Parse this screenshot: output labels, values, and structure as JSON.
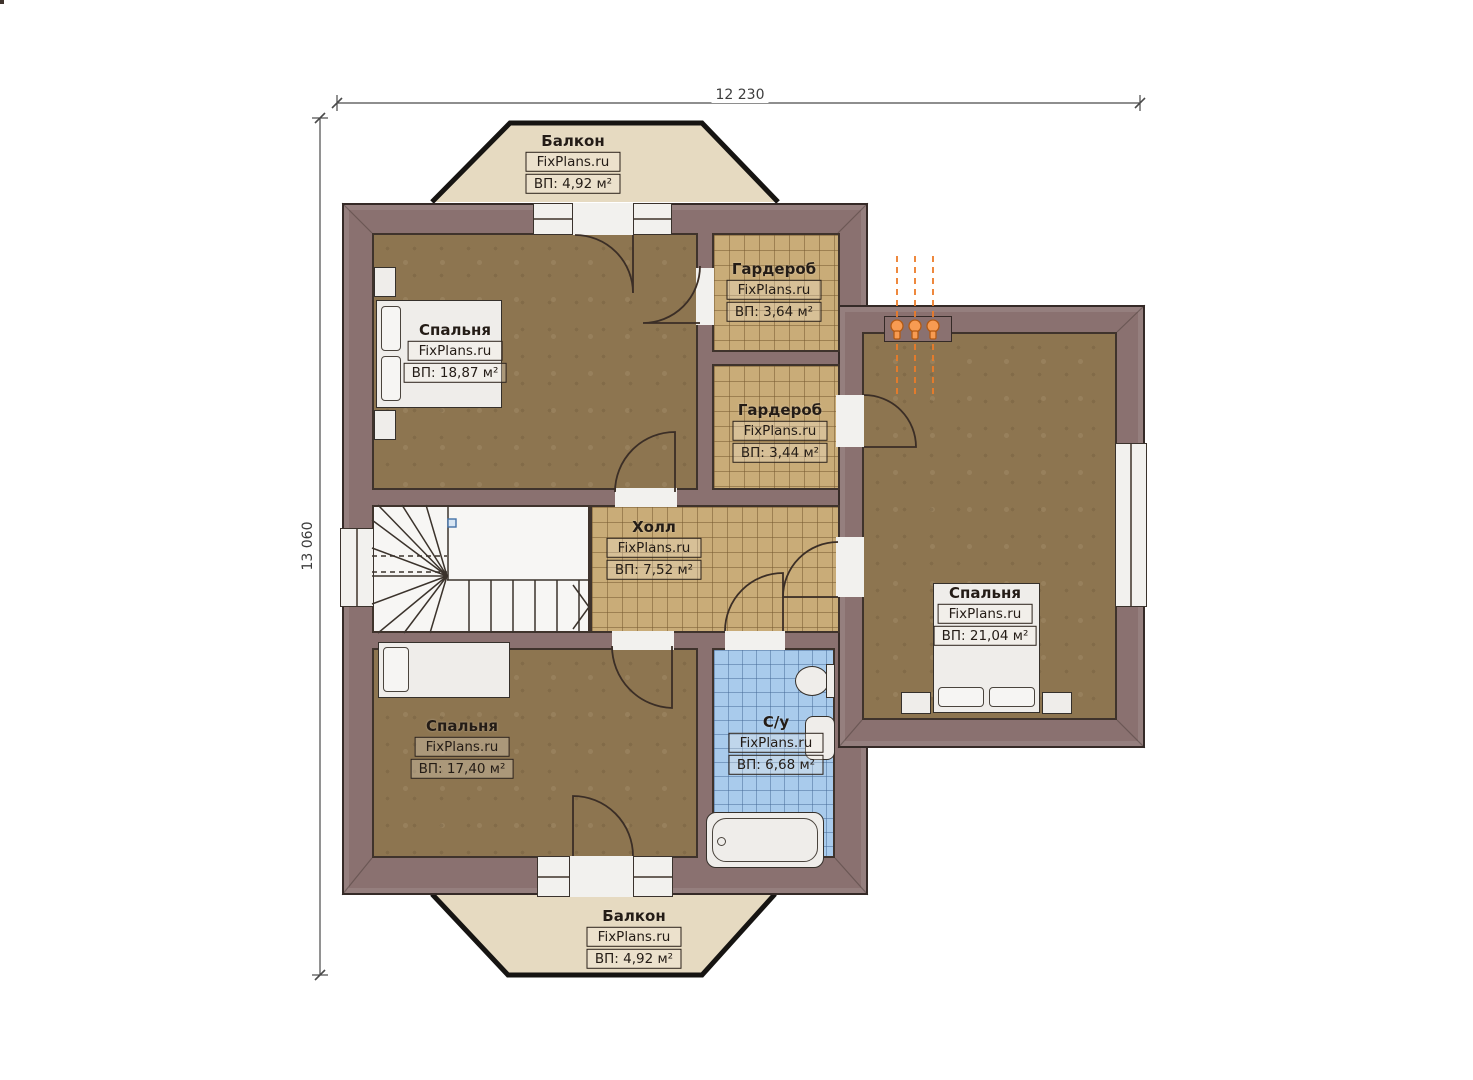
{
  "dimensions": {
    "width_label": "12 230",
    "height_label": "13 060"
  },
  "watermark": "FixPlans.ru",
  "rooms": [
    {
      "id": "balcony-top",
      "name": "Балкон",
      "area": "ВП: 4,92 м²"
    },
    {
      "id": "bedroom-top-left",
      "name": "Спальня",
      "area": "ВП: 18,87 м²"
    },
    {
      "id": "wardrobe-top",
      "name": "Гардероб",
      "area": "ВП: 3,64 м²"
    },
    {
      "id": "wardrobe-middle",
      "name": "Гардероб",
      "area": "ВП: 3,44 м²"
    },
    {
      "id": "hall",
      "name": "Холл",
      "area": "ВП: 7,52 м²"
    },
    {
      "id": "bedroom-right",
      "name": "Спальня",
      "area": "ВП: 21,04 м²"
    },
    {
      "id": "bedroom-bottom-left",
      "name": "Спальня",
      "area": "ВП: 17,40 м²"
    },
    {
      "id": "bathroom",
      "name": "С/у",
      "area": "ВП: 6,68 м²"
    },
    {
      "id": "balcony-bottom",
      "name": "Балкон",
      "area": "ВП: 4,92 м²"
    }
  ],
  "colors": {
    "wall": "#8a7170",
    "floor_wood": "#8d7550",
    "tile_tan": "#c9ac78",
    "tile_blue": "#a9cbec",
    "balcony": "#e6dac1",
    "flame_accent": "#e87c28"
  }
}
